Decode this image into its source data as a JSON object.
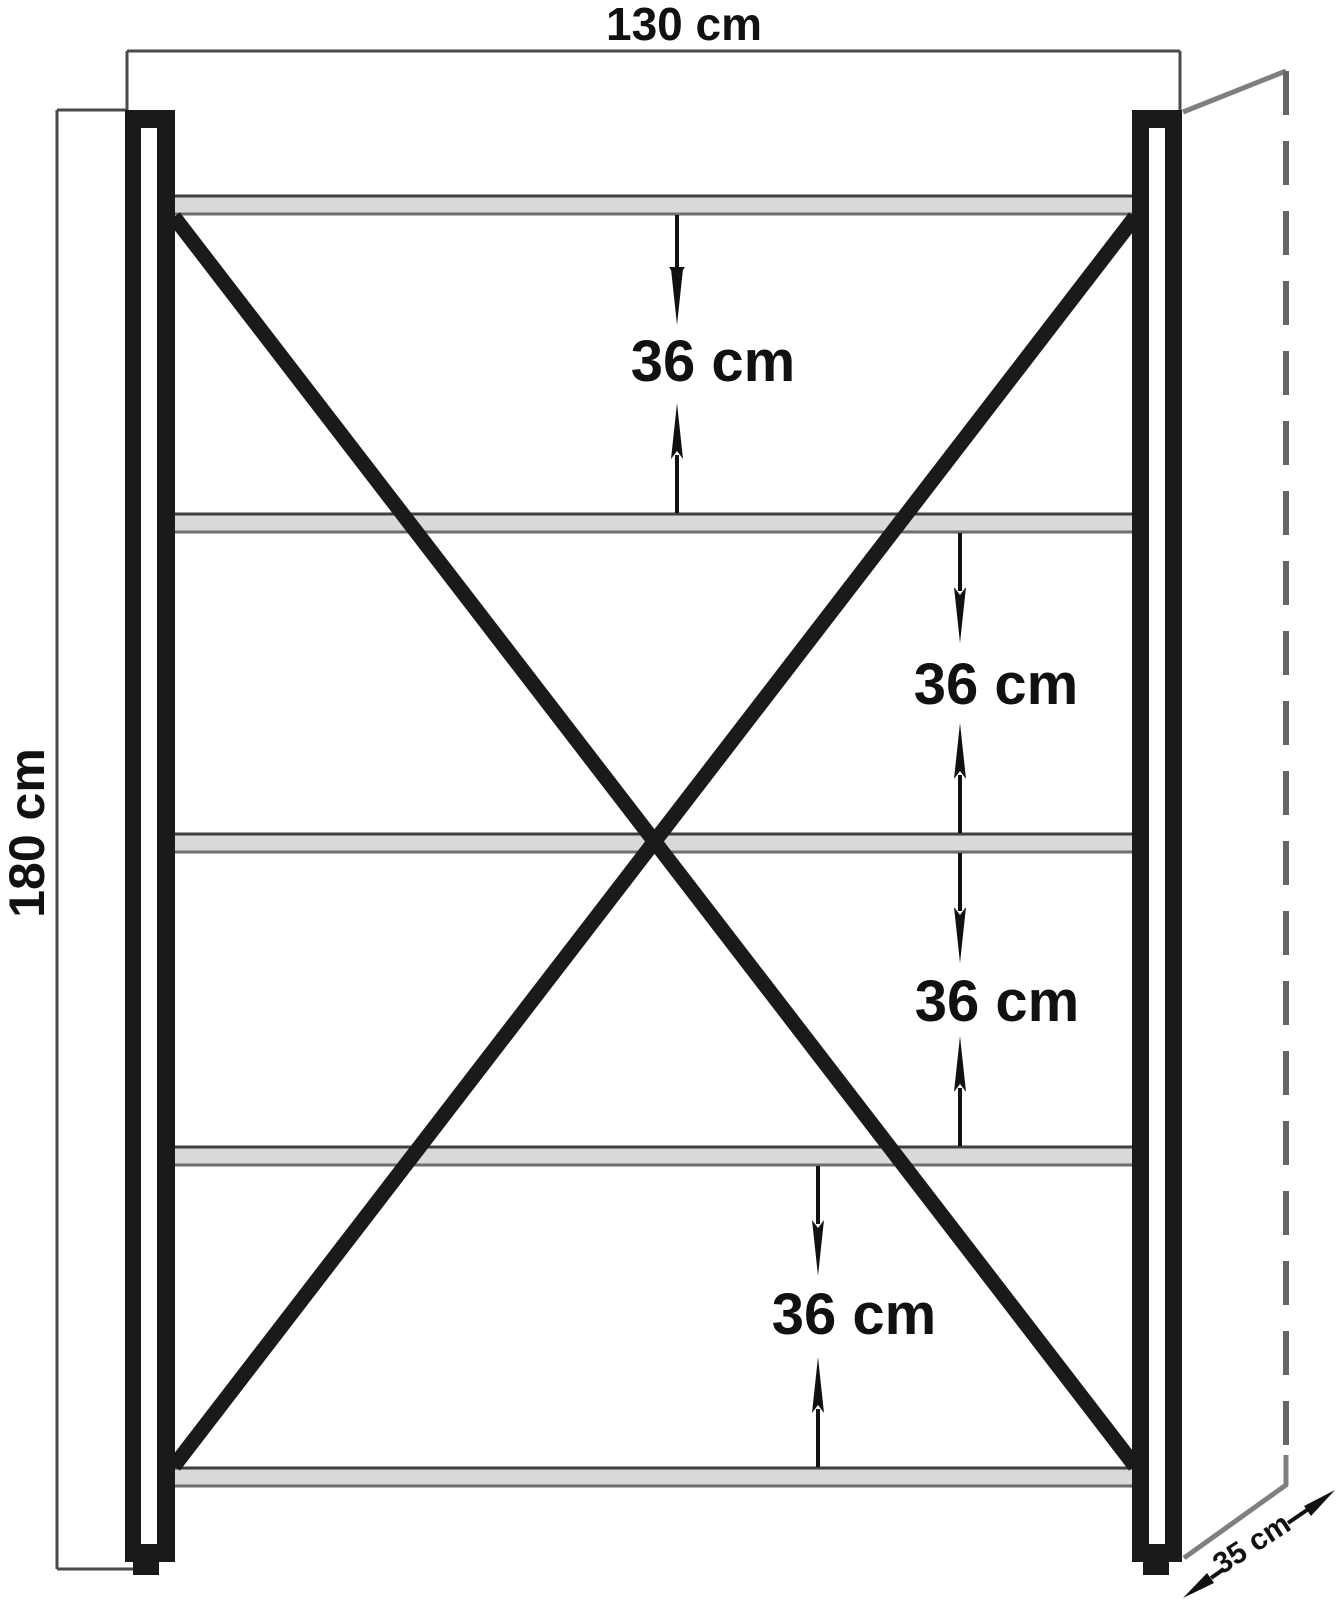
{
  "drawing": {
    "type": "furniture-dimension-diagram",
    "unit": "cm",
    "width_dimension": {
      "label": "130 cm",
      "value": 130
    },
    "height_dimension": {
      "label": "180 cm",
      "value": 180
    },
    "depth_dimension": {
      "label": "35 cm",
      "value": 35
    },
    "shelf_count": 5,
    "gap_dimensions": [
      {
        "label": "36 cm",
        "value": 36
      },
      {
        "label": "36 cm",
        "value": 36
      },
      {
        "label": "36 cm",
        "value": 36
      },
      {
        "label": "36 cm",
        "value": 36
      }
    ],
    "colors": {
      "background": "#ffffff",
      "frame": "#1a1a1a",
      "shelf_fill": "#d9d9d9",
      "shelf_edge_top": "#3f3f3f",
      "shelf_edge_bottom": "#6e6e6e",
      "dimension_line": "#4a4a4a",
      "arrow": "#111111",
      "perspective_line": "#7f7f7f",
      "dashed_depth_line": "#666666"
    }
  }
}
